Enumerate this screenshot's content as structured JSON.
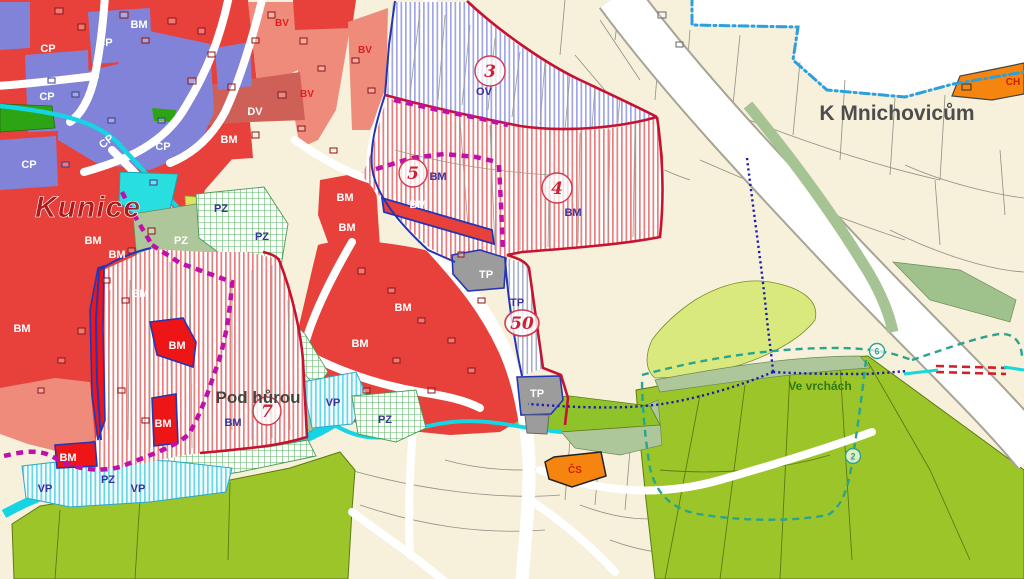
{
  "map": {
    "place_names": {
      "kunice": "Kunice",
      "k_mnichovicum": "K Mnichovicům",
      "pod_hurou": "Pod hůrou",
      "ve_vrchach": "Ve vrchách"
    },
    "zone_codes": {
      "BM": "BM",
      "BV": "BV",
      "CP": "CP",
      "DV": "DV",
      "OV": "OV",
      "PZ": "PZ",
      "VP": "VP",
      "TP": "TP",
      "CH": "CH",
      "CS": "ČS"
    },
    "area_numbers": {
      "n2": "2",
      "n3": "3",
      "n4": "4",
      "n5": "5",
      "n6": "6",
      "n7": "7",
      "n50": "50"
    },
    "colors": {
      "bm_red": "#e8403a",
      "bright_red": "#ed1515",
      "bv_salmon": "#ef8b7b",
      "cp_purple": "#8083d8",
      "dv_red": "#cf6058",
      "green_public": "#2da414",
      "field_green": "#9cc52a",
      "lime": "#d9e97e",
      "sage": "#adc79a",
      "water_cyan": "#15d4e4",
      "turquoise": "#29dede",
      "cream": "#f7f0da",
      "tp_gray": "#9c9c9c",
      "orange": "#f5850f",
      "boundary_red": "#c51330",
      "stage_magenta": "#bf10ab",
      "municipal_blue": "#2d9fdd",
      "route_teal": "#2aa38f",
      "route_navy": "#1c1cb2",
      "zone_text_purple": "#3c2f9e"
    }
  }
}
